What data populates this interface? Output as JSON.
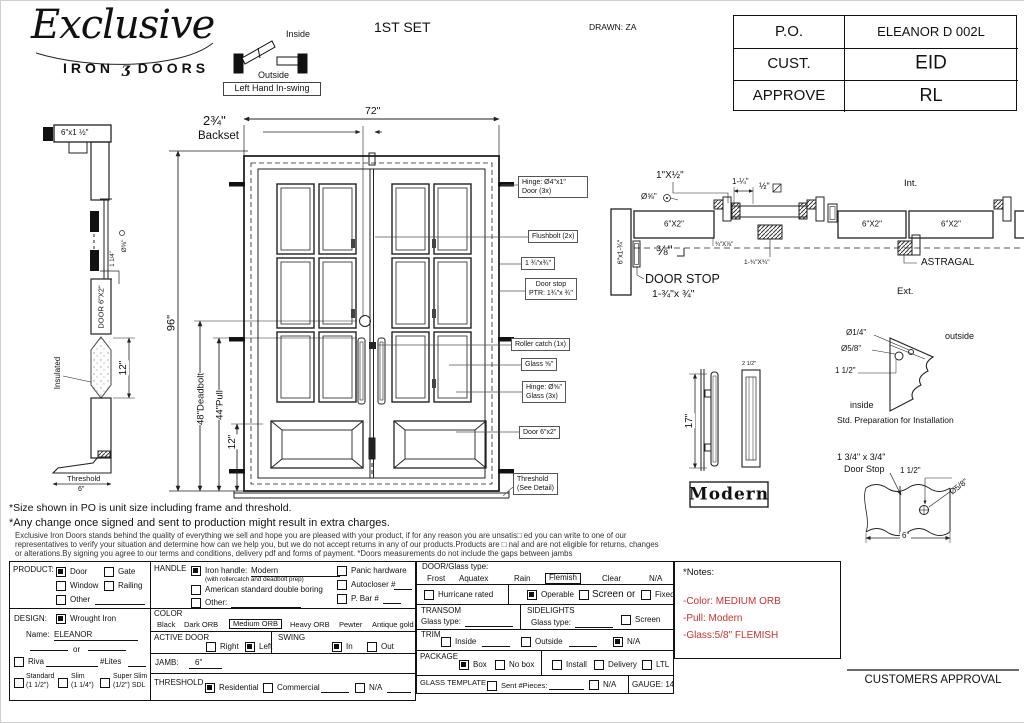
{
  "header": {
    "logo_script": "Exclusive",
    "logo_iron": "IRON",
    "logo_amp": "ʒ",
    "logo_doors": "DOORS",
    "inside": "Inside",
    "outside": "Outside",
    "swing_tag": "Left Hand In-swing",
    "set_title": "1ST SET",
    "drawn": "DRAWN: ZA"
  },
  "po_table": {
    "rows": [
      {
        "label": "P.O.",
        "value": "ELEANOR D 002L"
      },
      {
        "label": "CUST.",
        "value": "EID"
      },
      {
        "label": "APPROVE",
        "value": "RL"
      }
    ]
  },
  "front": {
    "dim_width": "72\"",
    "backset_value": "2¾\"",
    "backset_label": "Backset",
    "dim_height": "96\"",
    "dim_deadbolt": "48\"Deadbolt",
    "dim_pull": "44\"Pull",
    "dim_pull_len": "12\"",
    "callouts": [
      "Hinge: Ø4\"x1\"\nDoor (3x)",
      "Flushbolt (2x)",
      "1 ¾\"x¾\"",
      "Door stop\nPTR: 1¾\"x ¾\"",
      "Roller catch (1x)",
      "Glass ⅝\"",
      "Hinge: Ø⅝\"\nGlass (3x)",
      "Door 6\"x2\"",
      "Threshold\n(See Detail)"
    ]
  },
  "side": {
    "top_label": "6\"x1 ½\"",
    "dia_label": "Ø⅝\"",
    "quarter_label": "1 1/4\"",
    "door_label": "DOOR 6\"X2\"",
    "insulated": "Insulated",
    "dim_12": "12\"",
    "threshold": "Threshold",
    "dim_6": "6\""
  },
  "plan": {
    "lbl_1xhalf": "1\"X½\"",
    "dia_58": "Ø⅝\"",
    "lbl_114": "1-¼\"",
    "lbl_half": "½\"",
    "block1": "6\"X2\"",
    "block2": "6\"X2\"",
    "block3": "6\"X2\"",
    "jamb_label": "6\"x1-¾\"",
    "lbl_38": "⅜\"",
    "lbl_3478": "¾\"X⅞\"",
    "lbl_13434": "1-¾\"X¾\"",
    "door_stop_title": "DOOR STOP",
    "door_stop_size": "1-¾\"x ¾\"",
    "int_label": "Int.",
    "ext_label": "Ext.",
    "astragal": "ASTRAGAL"
  },
  "handle": {
    "dim_17": "17\"",
    "dim_25": "2 1/2\"",
    "name": "Modern"
  },
  "prep": {
    "dia_14": "Ø1/4\"",
    "dia_58": "Ø5/8\"",
    "dim_112": "1 1/2\"",
    "outside": "outside",
    "inside": "inside",
    "caption": "Std. Preparation for Installation"
  },
  "stop": {
    "size": "1 3/4\" x 3/4\"",
    "name": "Door Stop",
    "dim_112": "1 1/2\"",
    "dia_58": "Ø5/8\"",
    "dim_6": "6\""
  },
  "disclaimer": {
    "line1": "*Size shown in PO is unit size including frame and threshold.",
    "line2": "*Any change once signed and sent to production might result in extra charges.",
    "fine1": "Exclusive Iron Doors stands behind the quality of everything we sell and hope you are pleased with your product, if for any reason you are unsatis□ ed you can write to one of our",
    "fine2": "representatives to verify your situation and determine how can we help you, but we do not accept returns in any of our products.Products are □ nal and are not eligible for returns, changes",
    "fine3": "or alterations.By signing you agree to our terms and conditions, delivery pdf and forms of payment. *Doors measurements do not include the gaps between jambs"
  },
  "form": {
    "product": {
      "label": "PRODUCT:",
      "door": "Door",
      "gate": "Gate",
      "window": "Window",
      "railing": "Railing",
      "other": "Other"
    },
    "handle": {
      "label": "HANDLE",
      "iron": "Iron handle:",
      "iron_value": "Modern",
      "iron_note": "(with rollercatch and deadbolt prep)",
      "american": "American standard double boring",
      "other": "Other:",
      "panic": "Panic hardware",
      "autocloser": "Autocloser #",
      "pbar": "P. Bar #"
    },
    "design": {
      "label": "DESIGN:",
      "wrought": "Wrought Iron",
      "name_label": "Name:",
      "name_value": "ELEANOR",
      "or": "or",
      "riva": "Riva",
      "lites": "#Lites",
      "standard": "Standard",
      "standard_size": "(1 1/2\")",
      "slim": "Slim",
      "slim_size": "(1 1/4\")",
      "superslim": "Super Slim",
      "superslim_size": "(1/2\") SDL"
    },
    "color": {
      "label": "COLOR",
      "black": "Black",
      "dark": "Dark ORB",
      "medium": "Medium ORB",
      "heavy": "Heavy ORB",
      "pewter": "Pewter",
      "antique": "Antique gold"
    },
    "active": {
      "label": "ACTIVE DOOR",
      "right": "Right",
      "left": "Left"
    },
    "swing": {
      "label": "SWING",
      "in": "In",
      "out": "Out"
    },
    "jamb": {
      "label": "JAMB:",
      "value": "6\""
    },
    "threshold": {
      "label": "THRESHOLD",
      "residential": "Residential",
      "commercial": "Commercial",
      "na": "N/A"
    },
    "glass": {
      "label": "DOOR/Glass type:",
      "frost": "Frost",
      "aquatex": "Aquatex",
      "rain": "Rain",
      "flemish": "Flemish",
      "clear": "Clear",
      "na": "N/A"
    },
    "hurricane": "Hurricane rated",
    "operable": "Operable",
    "screen_or": "Screen or",
    "fixed": "Fixed",
    "transom": {
      "label": "TRANSOM",
      "glass_type": "Glass type:"
    },
    "sidelights": {
      "label": "SIDELIGHTS",
      "glass_type": "Glass type:",
      "screen": "Screen"
    },
    "trim": {
      "label": "TRIM",
      "inside": "Inside",
      "outside": "Outside",
      "na": "N/A"
    },
    "package": {
      "label": "PACKAGE",
      "box": "Box",
      "nobox": "No box",
      "install": "Install",
      "delivery": "Delivery",
      "ltl": "LTL"
    },
    "template": {
      "label": "GLASS TEMPLATE",
      "sent": "Sent #Pieces:",
      "na": "N/A"
    },
    "gauge": "GAUGE: 14"
  },
  "notes": {
    "title": "*Notes:",
    "color_note": "-Color: MEDIUM ORB",
    "pull_note": "-Pull: Modern",
    "glass_note": "-Glass:5/8\" FLEMISH",
    "accent": "#c83232"
  },
  "approval": "CUSTOMERS APPROVAL"
}
